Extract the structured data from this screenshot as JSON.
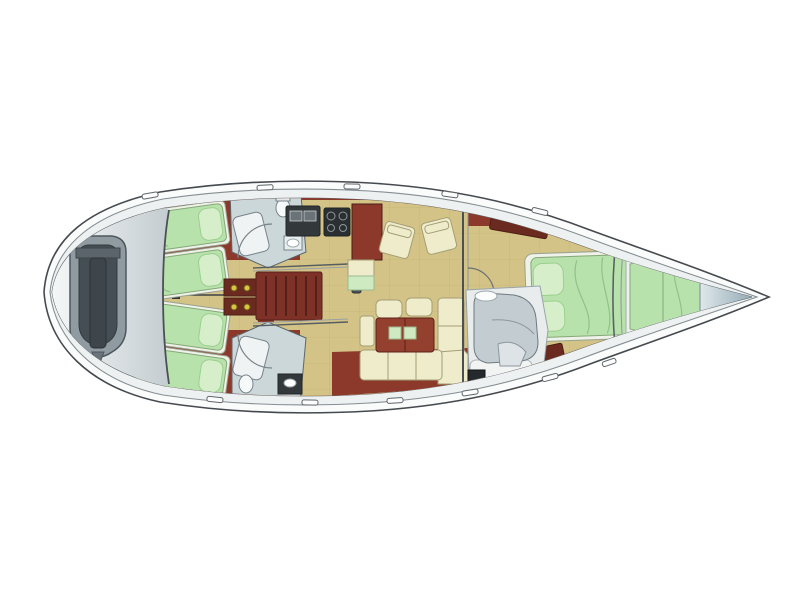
{
  "window": {
    "width": 800,
    "height": 599,
    "background": "#ffffff"
  },
  "plan": {
    "type": "yacht-interior-floor-plan",
    "orientation": {
      "bow": "right",
      "stern": "left"
    },
    "colors": {
      "deck": "#eef1f1",
      "deck_inner": "#dde3e4",
      "gunwale": "#fafbfb",
      "cabinetry": "#8c392b",
      "cabinetry_mid": "#7e3227",
      "cabinetry_dark": "#6b2a20",
      "floor": "#d3c386",
      "berth": "#b7e2ac",
      "berth_light": "#d6efca",
      "linen": "#eef2e8",
      "bath": "#ccd7da",
      "fixture_white": "#eff3f3",
      "upholstery": "#efeccb",
      "table": "#93402f",
      "pad_green": "#cfe9c2",
      "appliance": "#33383b",
      "stove": "#2a2f31",
      "dinghy_tube": "#8f9ba1",
      "dinghy_floor": "#454e54",
      "dinghy_console": "#3e464c",
      "hanger": "#d9c53f",
      "mast": "#4a5055"
    },
    "regions": [
      {
        "name": "stern-tender-garage",
        "contains": "inflatable-dinghy"
      },
      {
        "name": "aft-cabin-port",
        "berths": 2
      },
      {
        "name": "aft-cabin-starboard",
        "berths": 2
      },
      {
        "name": "aft-head-port",
        "fixtures": "shower-toilet-sink"
      },
      {
        "name": "aft-head-starboard",
        "fixtures": "shower-toilet-sink"
      },
      {
        "name": "companionway-stairs",
        "steps": 6
      },
      {
        "name": "galley",
        "fixtures": "sink-stove-counter-fridge"
      },
      {
        "name": "salon",
        "furniture": "two-armchairs-l-sofa-table-stools"
      },
      {
        "name": "owner-cabin",
        "berths": 1,
        "lockers": 2
      },
      {
        "name": "owner-ensuite",
        "fixtures": "shower-seat-sink"
      },
      {
        "name": "forepeak-cabin",
        "berths": 1
      },
      {
        "name": "bow-anchor-locker"
      }
    ]
  }
}
